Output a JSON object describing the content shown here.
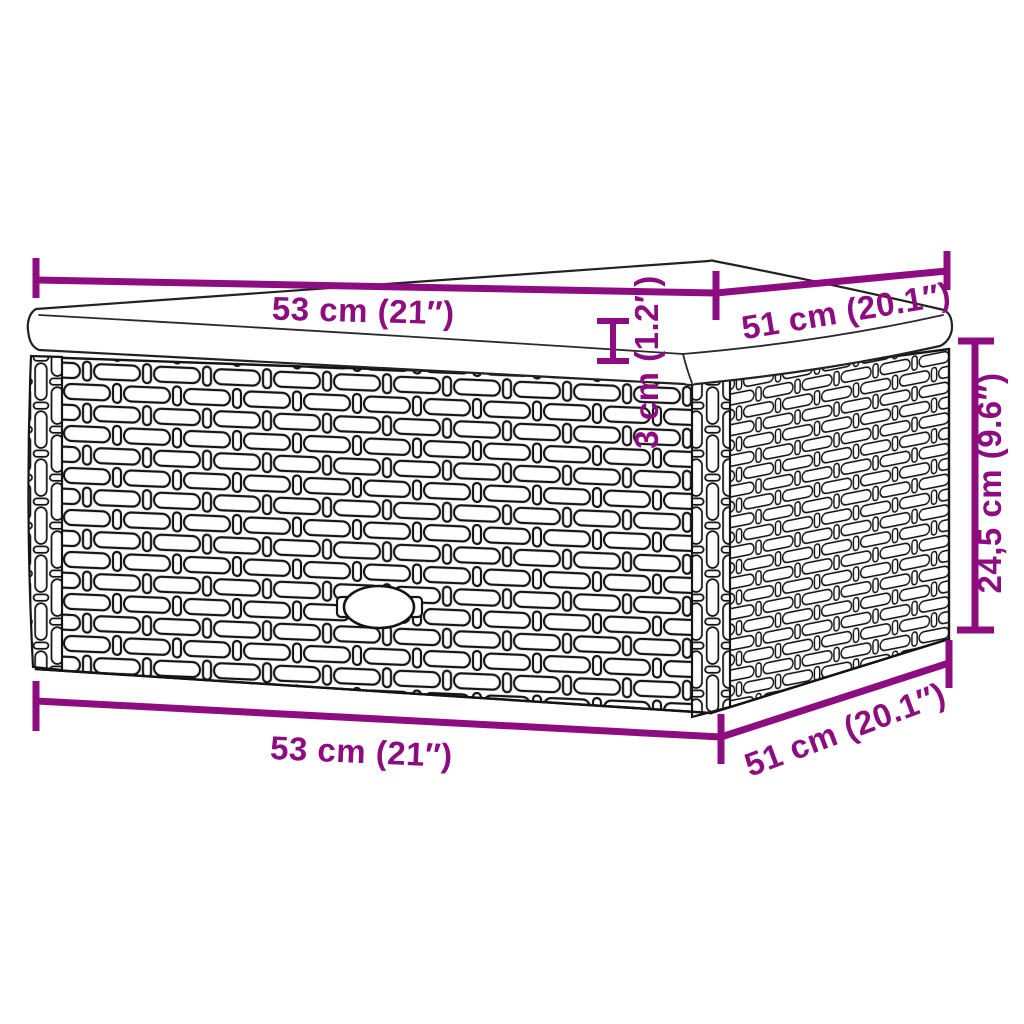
{
  "diagram": {
    "figure": "poly-rattan-ottoman-with-cushion",
    "colors": {
      "dimension_accent": "#8D0C7F",
      "drawing_line": "#141414",
      "background": "#FFFFFF"
    },
    "labels": {
      "top_width": "53 cm (21″)",
      "top_depth": "51 cm (20.1″)",
      "cushion_thickness": "3 cm (1.2″)",
      "height": "24,5 cm (9.6″)",
      "bottom_width": "53 cm (21″)",
      "bottom_depth": "51 cm (20.1″)"
    }
  }
}
